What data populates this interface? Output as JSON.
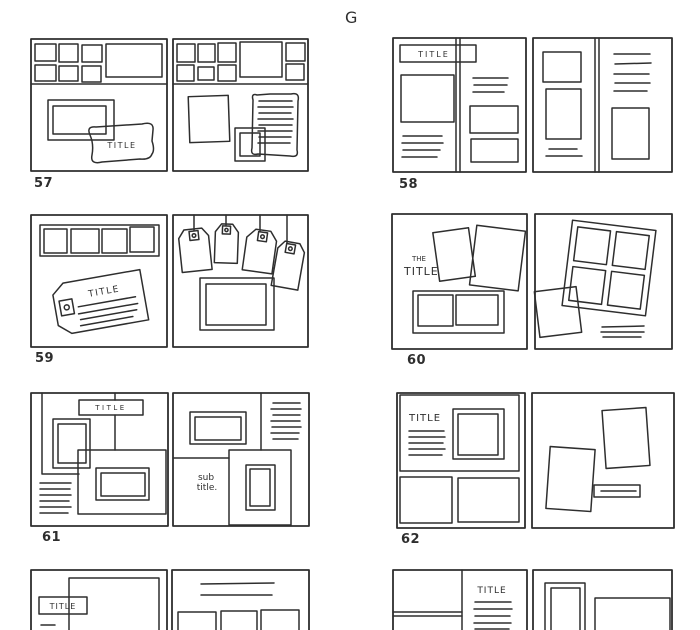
{
  "page": {
    "header_letter": "G",
    "ink_color": "#2e2e2e",
    "background_color": "#ffffff"
  },
  "sketches": [
    {
      "id": "57",
      "number": "57",
      "title": "TITLE"
    },
    {
      "id": "58",
      "number": "58",
      "title": "TITLE"
    },
    {
      "id": "59",
      "number": "59",
      "title": "TITLE"
    },
    {
      "id": "60",
      "number": "60",
      "title_prefix": "THE",
      "title": "TITLE"
    },
    {
      "id": "61",
      "number": "61",
      "title": "TITLE",
      "subtitle_line1": "sub",
      "subtitle_line2": "title."
    },
    {
      "id": "62",
      "number": "62",
      "title": "TITLE"
    },
    {
      "id": "63",
      "number": "",
      "title": "TITLE"
    },
    {
      "id": "64",
      "number": "",
      "title": "TITLE"
    }
  ]
}
